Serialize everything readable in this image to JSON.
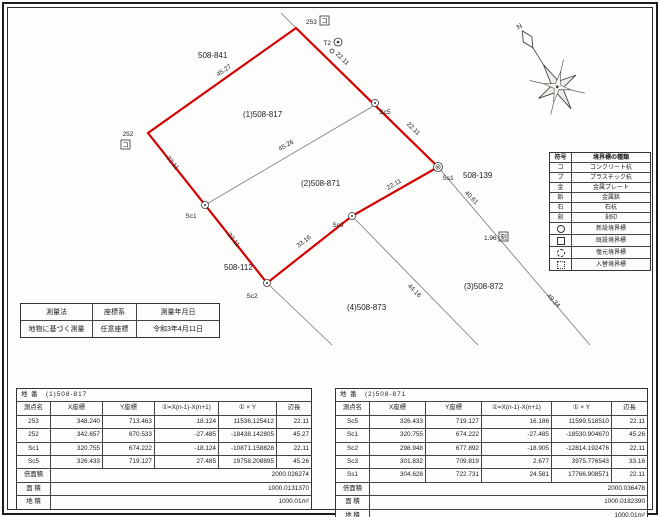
{
  "compass": {
    "north_label": "N"
  },
  "diagram": {
    "parcel_labels": {
      "neighbor_841": "508-841",
      "parcel1": "(1)508-817",
      "parcel2": "(2)508-871",
      "neighbor_112": "508-112",
      "neighbor_139": "508-139",
      "parcel3": "(3)508-872",
      "parcel4": "(4)508-873"
    },
    "points": {
      "p253": "253",
      "p252": "252",
      "t2": "T2",
      "sc5": "Sc5",
      "sc1": "Sc1",
      "sc2": "Sc2",
      "sc3": "Sc3",
      "ss1": "Ss1",
      "box253": "コ",
      "box252": "コ",
      "kizami": "刻"
    },
    "edges": {
      "e_top": "45.27",
      "e_253_sc5": "22.11",
      "e_sc5_ss1": "22.11",
      "e_diag": "45.26",
      "e_252_sc1": "22.11",
      "e_sc1_sc2": "22.11",
      "e_ss1_sc3": "22.11",
      "e_sc2_sc3": "33.16",
      "e_ext_4061": "40.61",
      "e_ext_196": "1.96",
      "e_ext_4416": "44.16",
      "e_ext_4934": "49.34"
    },
    "colors": {
      "parcel_outline": "#d40000",
      "thin_line": "#777777"
    }
  },
  "legend": {
    "headers": [
      "符号",
      "境界標の種類"
    ],
    "rows": [
      {
        "symbol": "コ",
        "icon": "text",
        "label": "コンクリート杭"
      },
      {
        "symbol": "プ",
        "icon": "text",
        "label": "プラスチック杭"
      },
      {
        "symbol": "金",
        "icon": "text",
        "label": "金属プレート"
      },
      {
        "symbol": "鋲",
        "icon": "text",
        "label": "金属鋲"
      },
      {
        "symbol": "石",
        "icon": "text",
        "label": "石杭"
      },
      {
        "symbol": "刻",
        "icon": "text",
        "label": "刻印"
      },
      {
        "symbol": "",
        "icon": "circle",
        "label": "新設境界標"
      },
      {
        "symbol": "",
        "icon": "square",
        "label": "既設境界標"
      },
      {
        "symbol": "",
        "icon": "circle-dashed",
        "label": "復元境界標"
      },
      {
        "symbol": "",
        "icon": "square-dashed",
        "label": "入替境界標"
      }
    ]
  },
  "survey_info": {
    "headers": [
      "測量法",
      "座標系",
      "測量年月日"
    ],
    "values": [
      "地物に基づく測量",
      "任意座標",
      "令和3年4月11日"
    ]
  },
  "tables": {
    "left": {
      "title_label": "地 番",
      "title_value": "(1)508-817",
      "headers": [
        "測点名",
        "X座標",
        "Y座標",
        "①=X(n-1)-X(n+1)",
        "① × Y",
        "辺長"
      ],
      "rows": [
        [
          "253",
          "348.240",
          "713.463",
          "18.124",
          "11536.125412",
          "22.11"
        ],
        [
          "252",
          "342.657",
          "670.533",
          "-27.485",
          "-18438.142805",
          "45.27"
        ],
        [
          "Sc1",
          "320.755",
          "674.222",
          "-18.124",
          "-10871.158828",
          "22.11"
        ],
        [
          "Sc5",
          "326.433",
          "719.127",
          "27.485",
          "19758.208895",
          "45.26"
        ]
      ],
      "footers": [
        [
          "倍面積",
          "2000.026274"
        ],
        [
          "面 積",
          "1000.0131370"
        ],
        [
          "地 積",
          "1000.01m²"
        ]
      ]
    },
    "right": {
      "title_label": "地 番",
      "title_value": "(2)508-871",
      "headers": [
        "測点名",
        "X座標",
        "Y座標",
        "①=X(n-1)-X(n+1)",
        "① × Y",
        "辺長"
      ],
      "rows": [
        [
          "Sc5",
          "326.433",
          "719.127",
          "16.186",
          "11599.518510",
          "22.11"
        ],
        [
          "Sc1",
          "320.755",
          "674.222",
          "-27.485",
          "-18530.904670",
          "45.26"
        ],
        [
          "Sc2",
          "298.948",
          "677.892",
          "-18.905",
          "-12814.192476",
          "22.11"
        ],
        [
          "Sc3",
          "301.832",
          "709.819",
          "2.677",
          "3975.776543",
          "33.16"
        ],
        [
          "Ss1",
          "304.628",
          "722.731",
          "24.581",
          "17766.908571",
          "22.11"
        ]
      ],
      "footers": [
        [
          "倍面積",
          "2000.036478"
        ],
        [
          "面 積",
          "1000.0182390"
        ],
        [
          "地 積",
          "1000.01m²"
        ]
      ]
    }
  }
}
